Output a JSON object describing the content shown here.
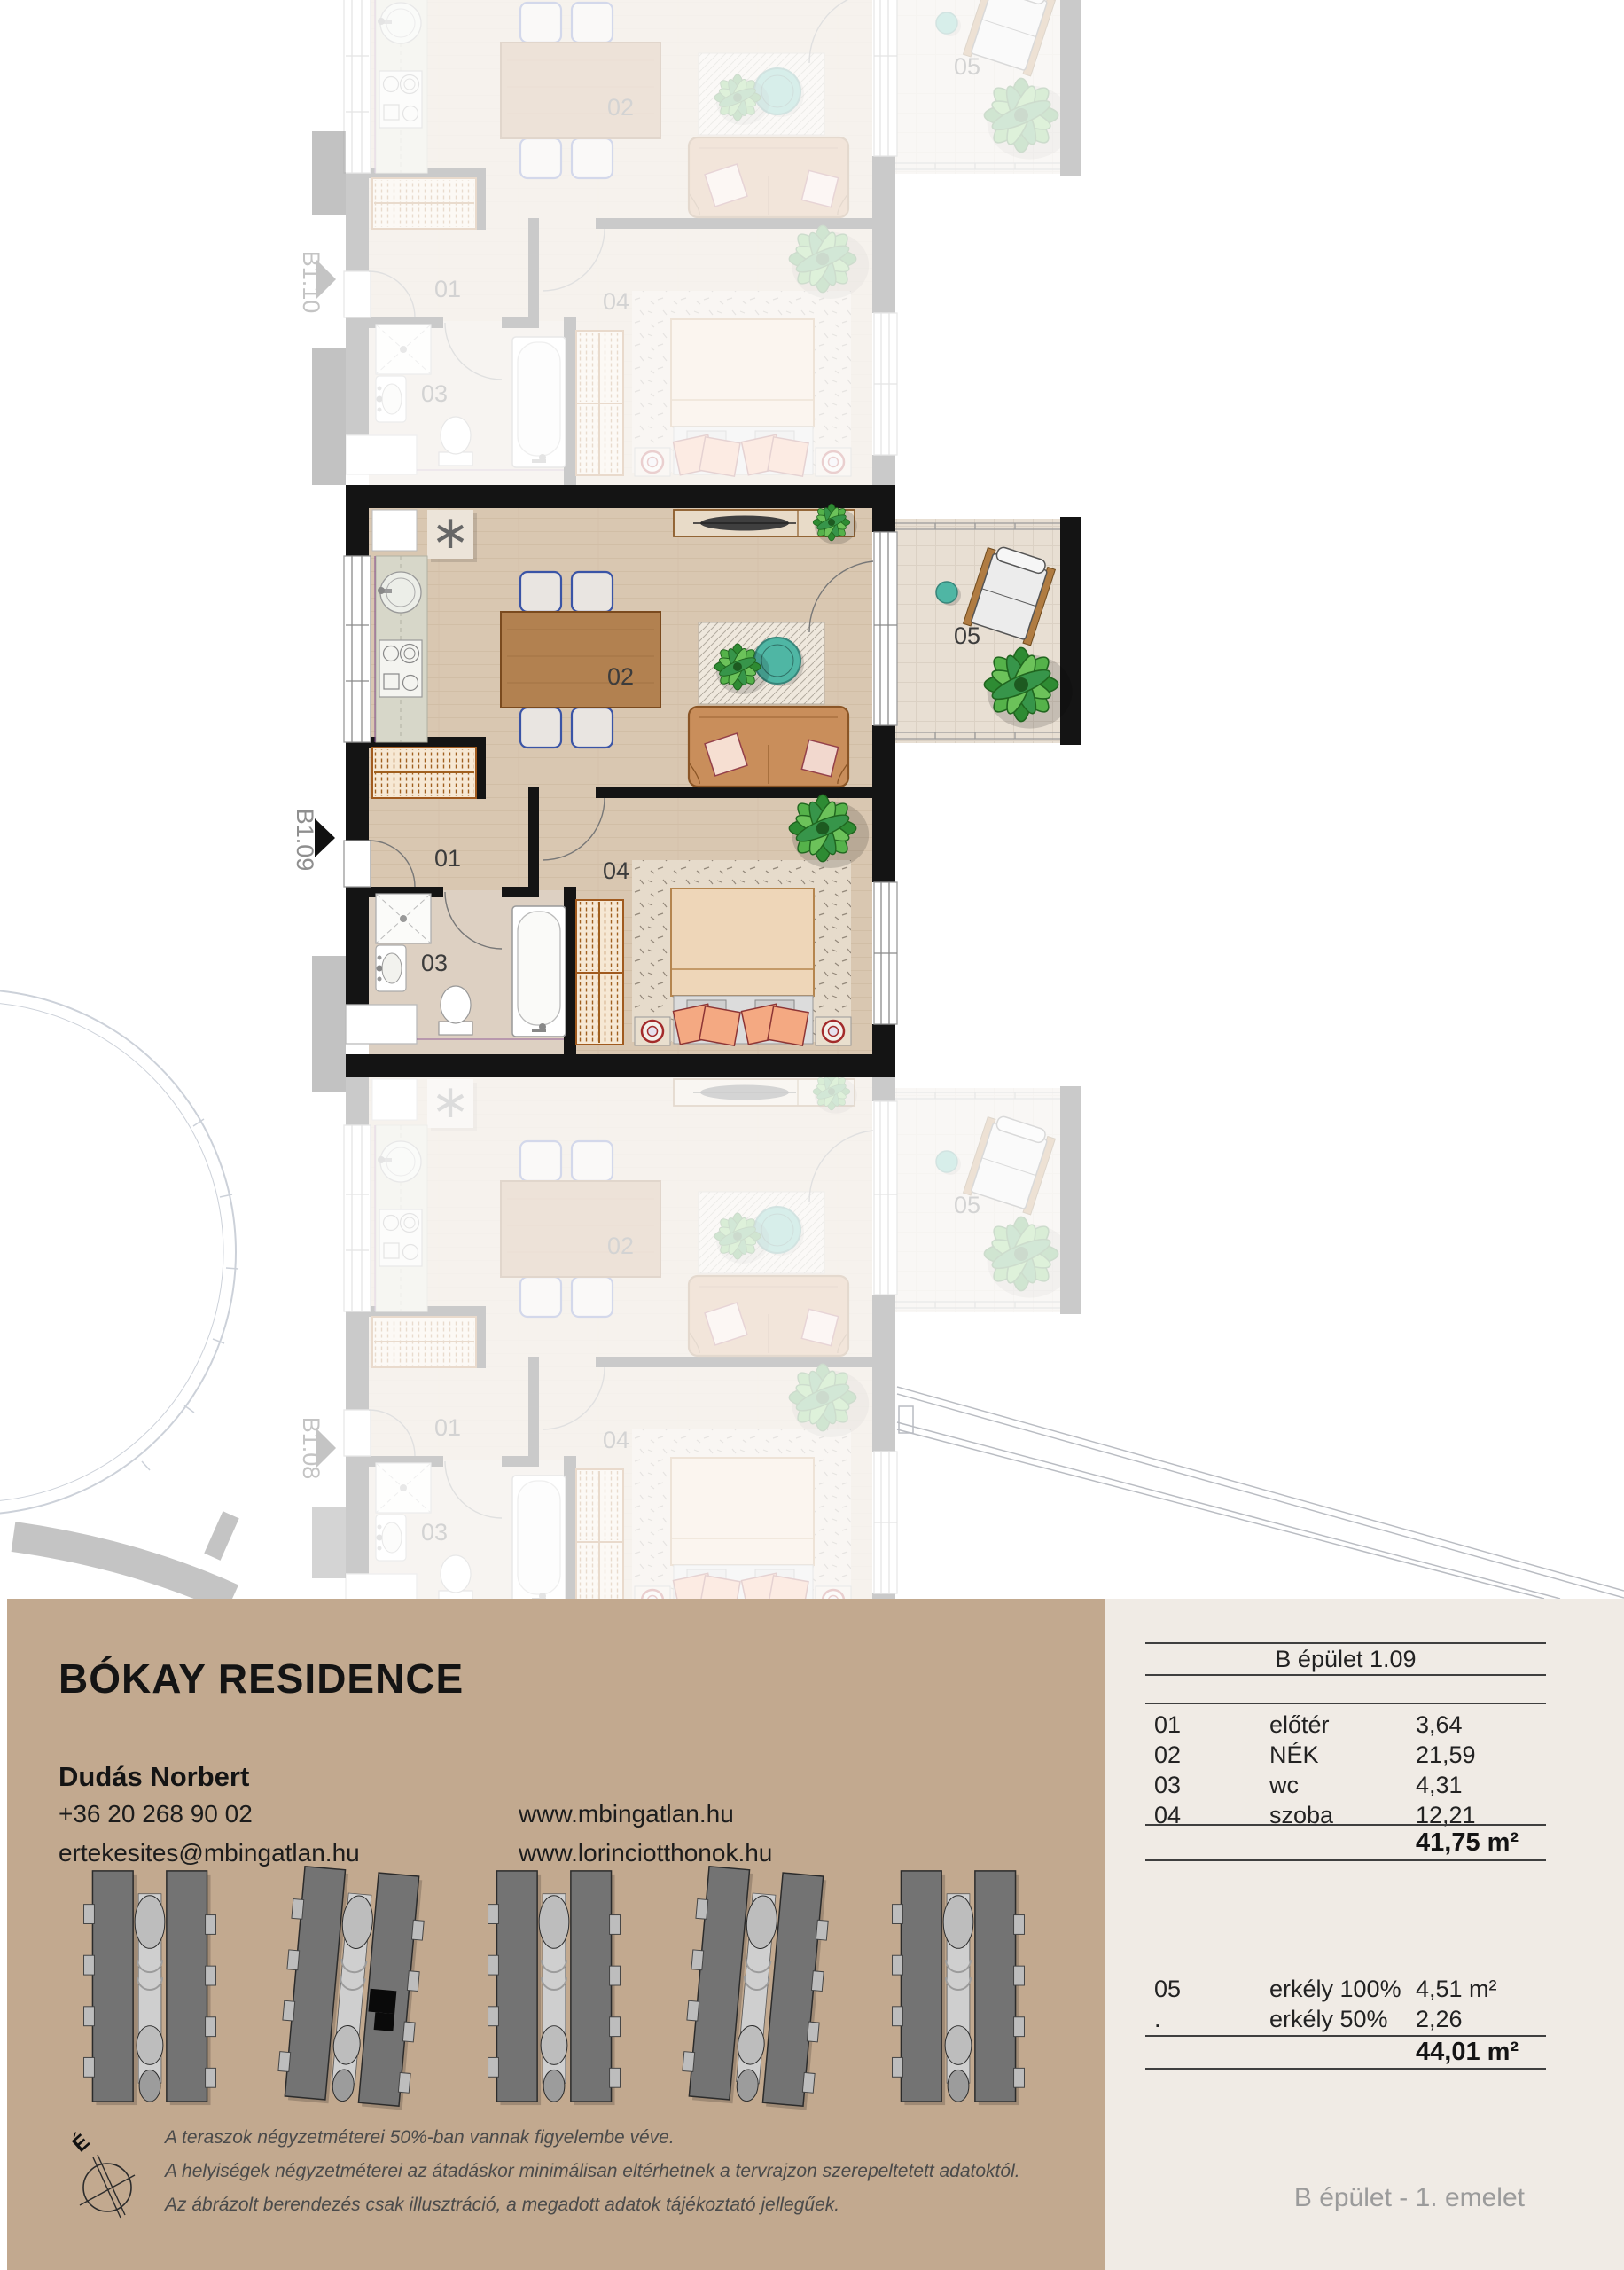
{
  "plan": {
    "rooms": [
      "01",
      "02",
      "03",
      "04",
      "05"
    ],
    "units": [
      "B1.10",
      "B1.09",
      "B1.08"
    ],
    "washer_symbol": "∗"
  },
  "info": {
    "title": "BÓKAY RESIDENCE",
    "contact": {
      "name": "Dudás Norbert",
      "phone": "+36 20 268 90 02",
      "email": "ertekesites@mbingatlan.hu"
    },
    "websites": [
      "www.mbingatlan.hu",
      "www.lorinciotthonok.hu"
    ],
    "disclaimer": [
      "A teraszok négyzetméterei 50%-ban vannak figyelembe véve.",
      "A helyiségek négyzetméterei az átadáskor minimálisan eltérhetnek a tervrajzon szerepeltetett adatoktól.",
      "Az ábrázolt berendezés csak illusztráció, a megadott adatok tájékoztató jellegűek."
    ],
    "compass": "É"
  },
  "table": {
    "header": "B épület 1.09",
    "rows": [
      {
        "no": "01",
        "name": "előtér",
        "area": "3,64"
      },
      {
        "no": "02",
        "name": "NÉK",
        "area": "21,59"
      },
      {
        "no": "03",
        "name": "wc",
        "area": "4,31"
      },
      {
        "no": "04",
        "name": "szoba",
        "area": "12,21"
      }
    ],
    "total_main": "41,75 m²",
    "rows_balcony": [
      {
        "no": "05",
        "name": "erkély 100%",
        "area": "4,51 m²"
      },
      {
        "no": ".",
        "name": "erkély 50%",
        "area": "2,26"
      }
    ],
    "total_all": "44,01 m²",
    "footer": "B épület - 1. emelet"
  },
  "colors": {
    "panel_tan": "#c2a98f",
    "panel_light": "#f0ebe5",
    "wall": "#141414",
    "floor_wood": "#d9c7b1",
    "bathroom_floor": "#ddd0c2",
    "balcony_floor": "#e8dfd3",
    "faded_gray": "#c7c7c7",
    "chair_blue": "#3a54a6",
    "sofa_tan": "#c98e5b",
    "plant_green": "#3f9140",
    "teal": "#4fb6a4"
  }
}
